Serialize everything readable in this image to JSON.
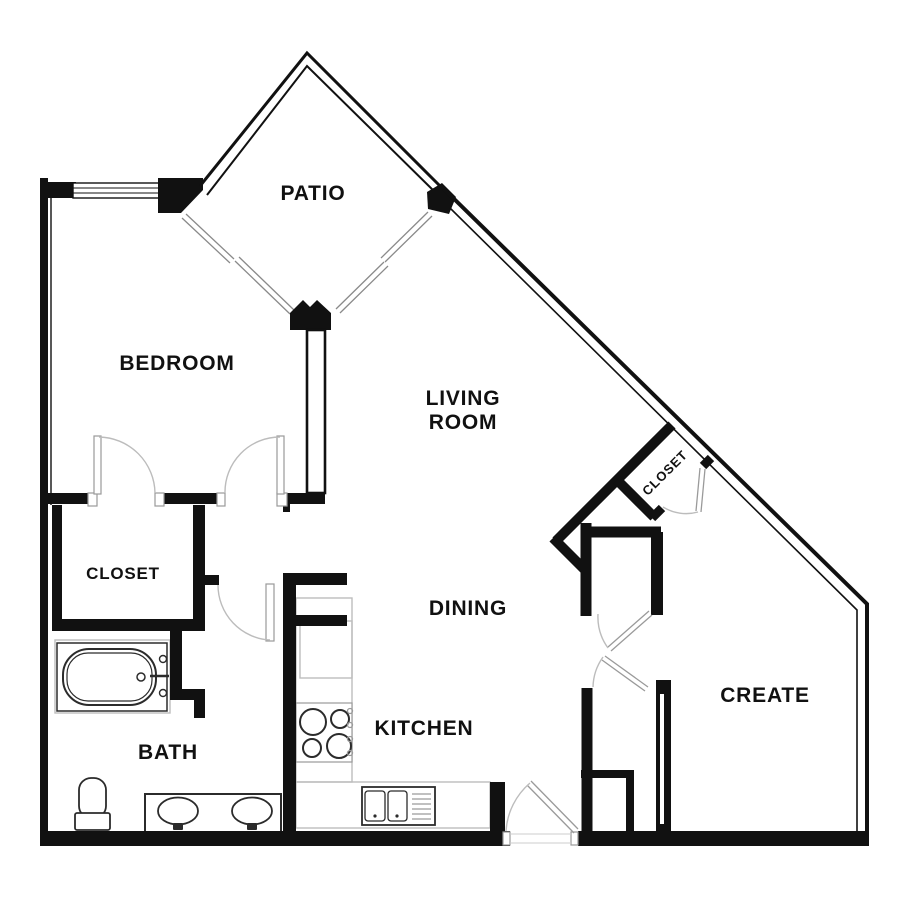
{
  "colors": {
    "background": "#ffffff",
    "wall": "#111111",
    "window": "#8a8a8a",
    "door": "#9a9a9a",
    "arc": "#bcbcbc",
    "counter": "#bdbdbd",
    "fixture": "#2b2b2b",
    "text": "#111111"
  },
  "rooms": {
    "patio": {
      "label": "PATIO"
    },
    "bedroom": {
      "label": "BEDROOM"
    },
    "living_room": {
      "line1": "LIVING",
      "line2": "ROOM"
    },
    "bedroom_closet": {
      "label": "CLOSET"
    },
    "entry_closet": {
      "label": "CLOSET"
    },
    "dining": {
      "label": "DINING"
    },
    "kitchen": {
      "label": "KITCHEN"
    },
    "bath": {
      "label": "BATH"
    },
    "create": {
      "label": "CREATE"
    }
  },
  "fixtures": [
    "bathtub",
    "toilet",
    "double-vanity-sinks",
    "range-stove",
    "refrigerator",
    "kitchen-sink",
    "kitchen-counter",
    "windows",
    "door-swings"
  ]
}
